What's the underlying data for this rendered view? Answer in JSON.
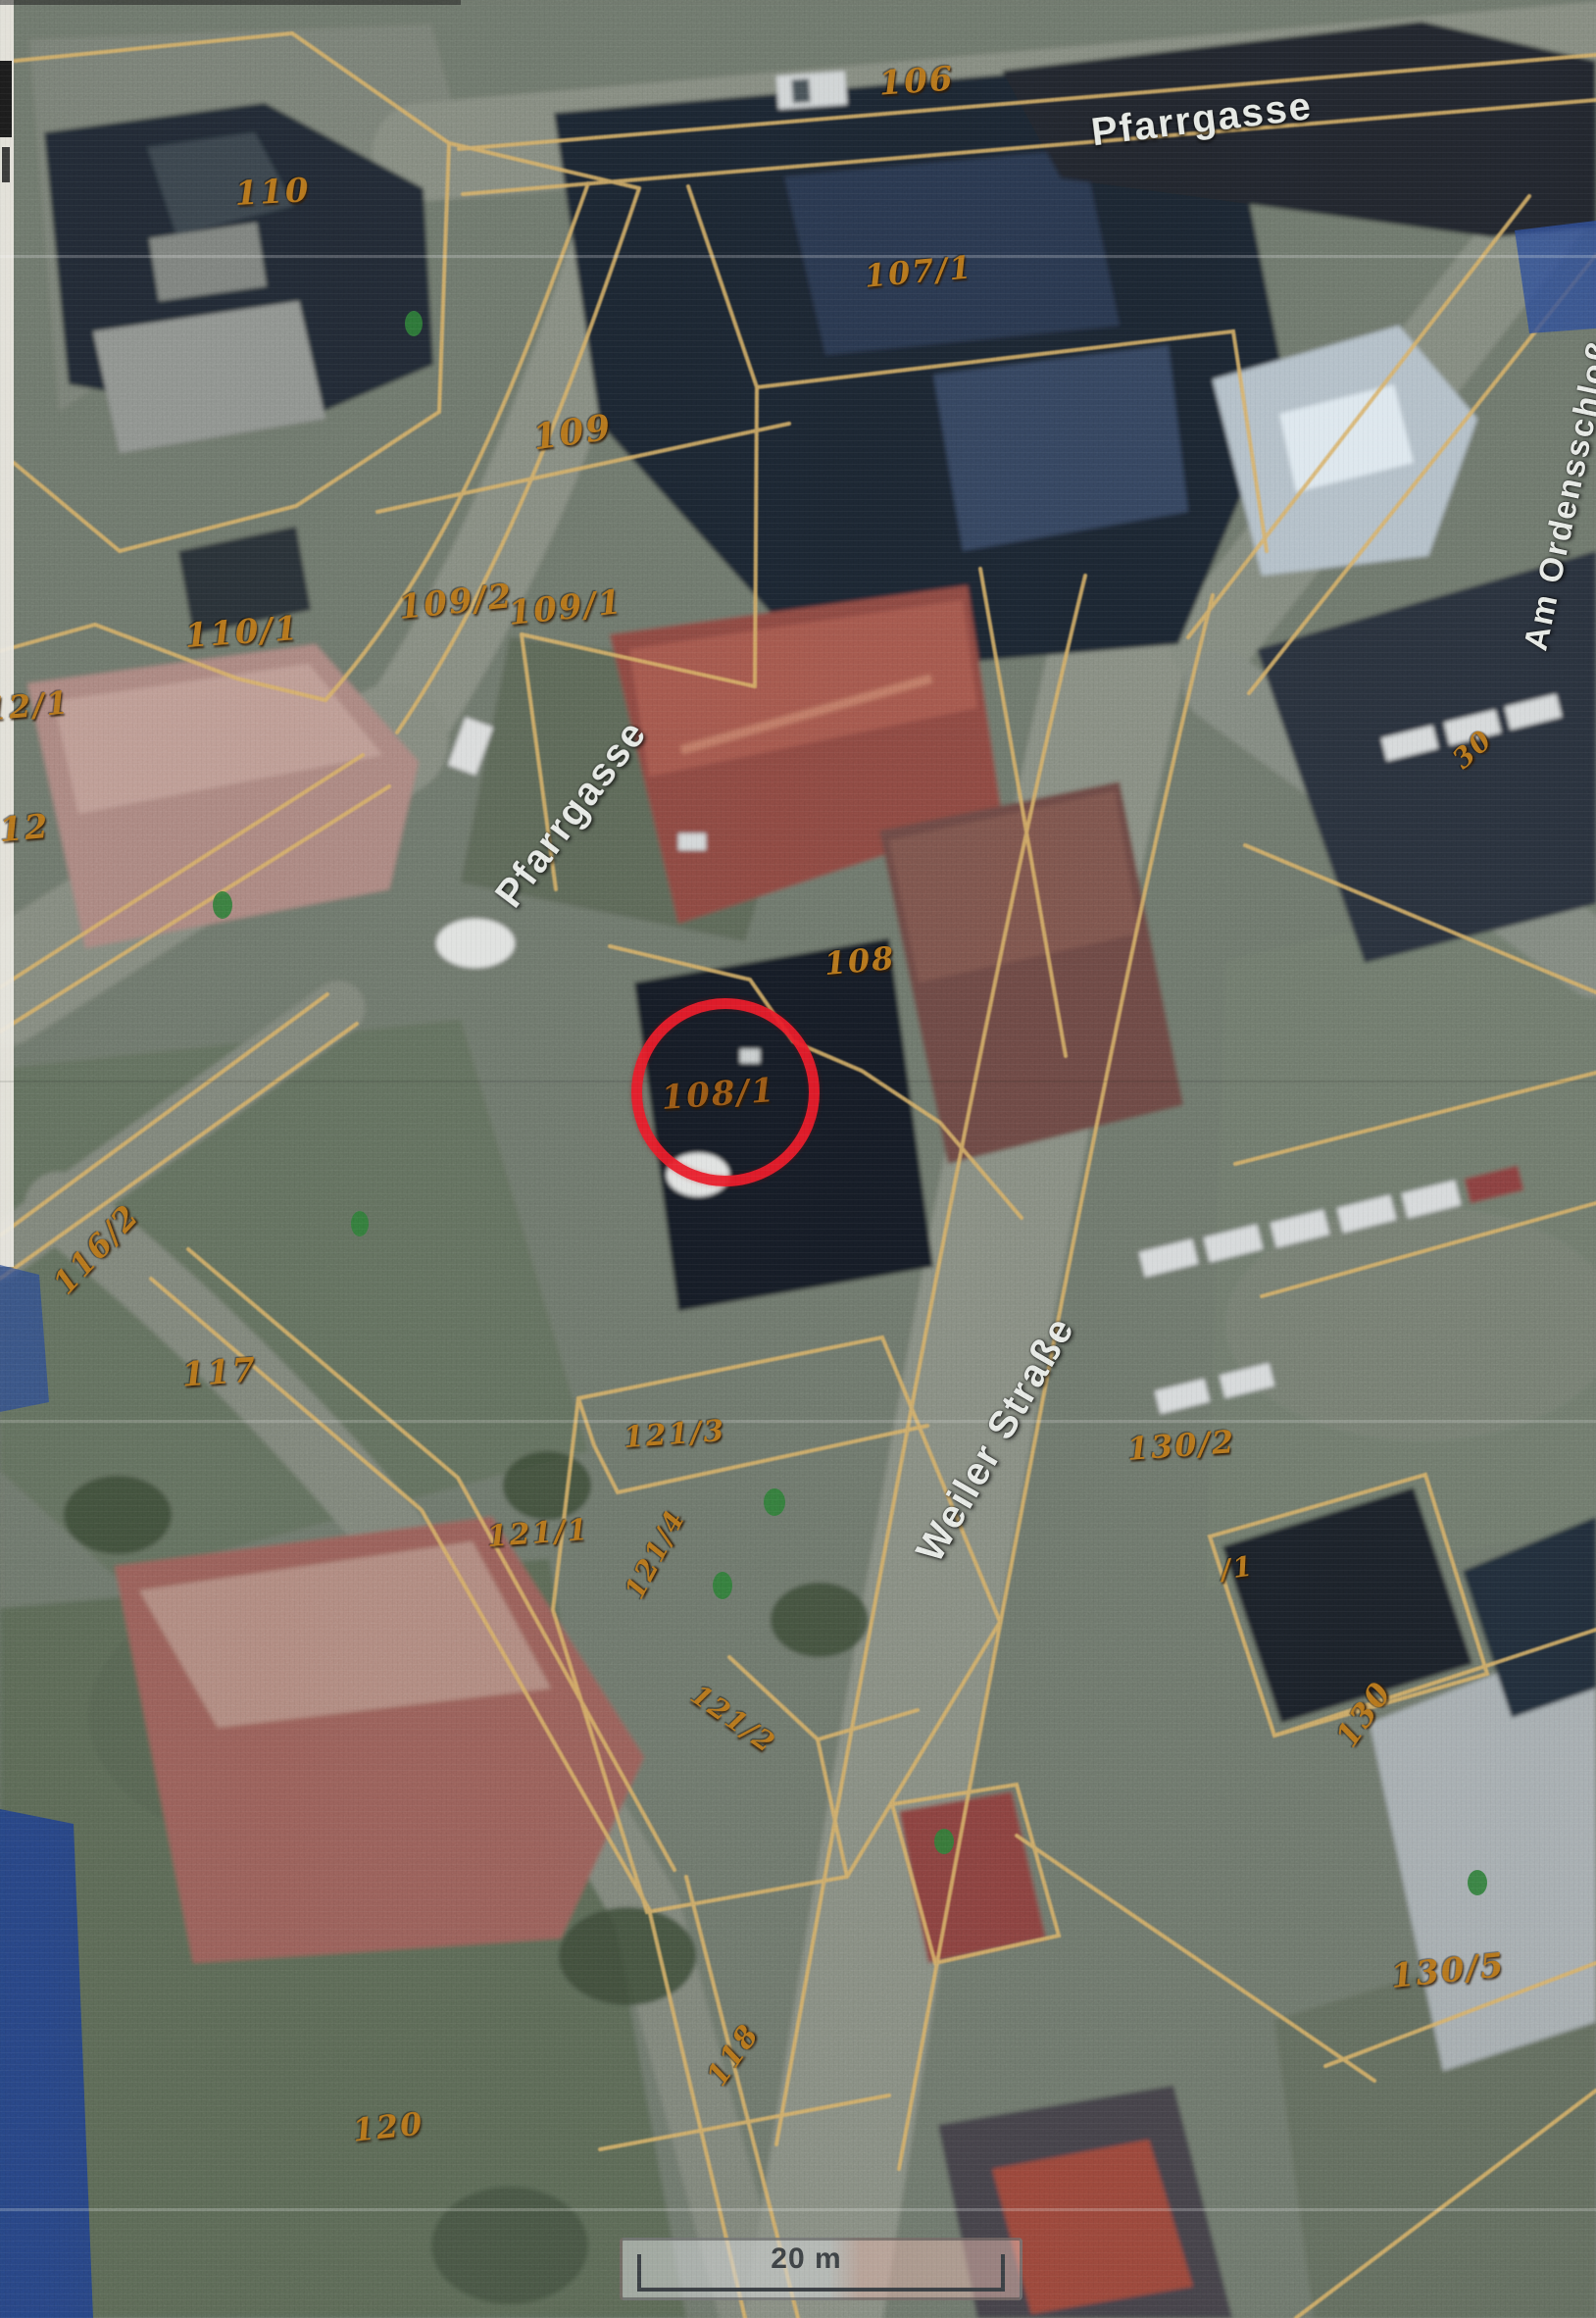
{
  "map": {
    "kind": "scanned aerial orthophoto with cadastral parcel overlay",
    "scale_bar": {
      "label": "20 m"
    },
    "highlight_circle": {
      "color": "#e91c2a",
      "around_parcel": "108/1"
    },
    "palette": {
      "parcel_line": "#d8b168",
      "parcel_label": "#b87a1e",
      "street_label": "#e7eae6"
    },
    "parcel_labels": [
      {
        "text": "106"
      },
      {
        "text": "110"
      },
      {
        "text": "107/1"
      },
      {
        "text": "109"
      },
      {
        "text": "109/2"
      },
      {
        "text": "109/1"
      },
      {
        "text": "110/1"
      },
      {
        "text": "12/1"
      },
      {
        "text": "12"
      },
      {
        "text": "108"
      },
      {
        "text": "108/1"
      },
      {
        "text": "30"
      },
      {
        "text": "116/2"
      },
      {
        "text": "117"
      },
      {
        "text": "121/3"
      },
      {
        "text": "121/1"
      },
      {
        "text": "121/4"
      },
      {
        "text": "121/2"
      },
      {
        "text": "130/2"
      },
      {
        "text": "/1"
      },
      {
        "text": "130"
      },
      {
        "text": "130/5"
      },
      {
        "text": "118"
      },
      {
        "text": "120"
      }
    ],
    "street_labels": [
      {
        "text": "Pfarrgasse"
      },
      {
        "text": "Pfarrgasse"
      },
      {
        "text": "Weiler Straße"
      },
      {
        "text": "Am Ordensschloß"
      }
    ]
  }
}
